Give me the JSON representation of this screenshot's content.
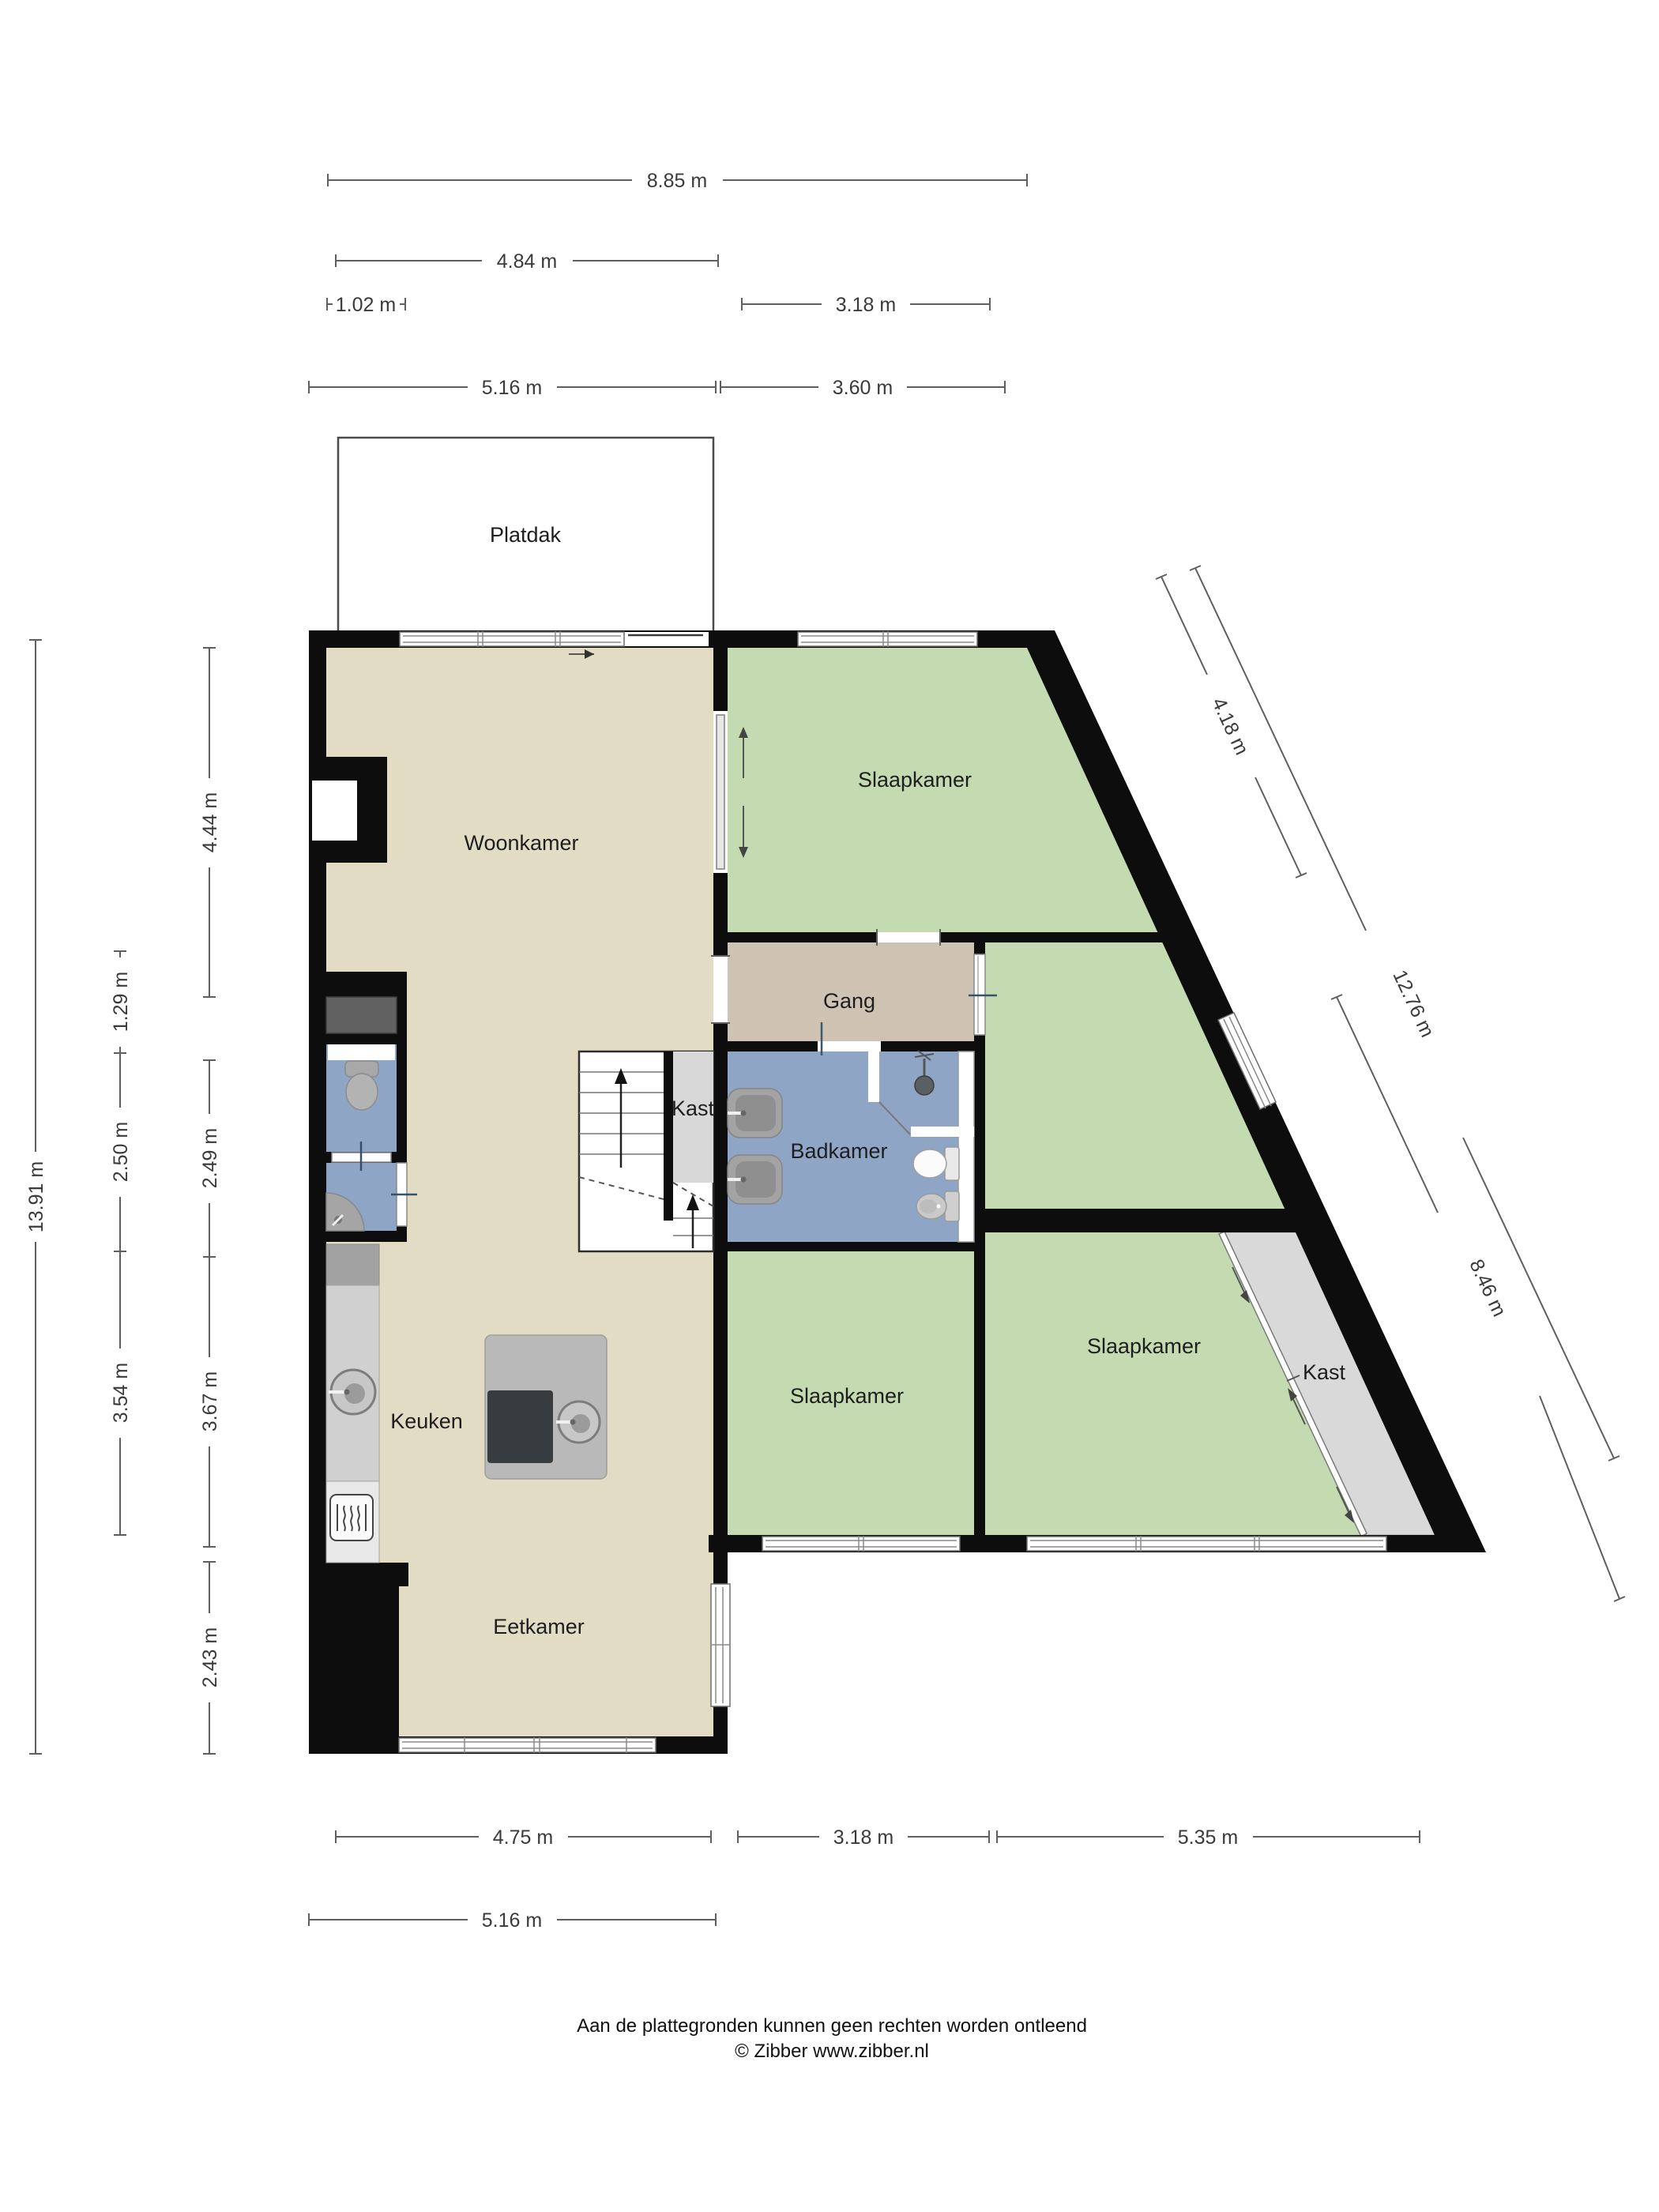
{
  "title": "Plattegrond verdieping",
  "rooms": {
    "platdak": "Platdak",
    "woonkamer": "Woonkamer",
    "slaapkamer_top": "Slaapkamer",
    "gang": "Gang",
    "kast_trap": "Kast",
    "badkamer": "Badkamer",
    "slaapkamer_mid": "Slaapkamer",
    "slaapkamer_rechts": "Slaapkamer",
    "kast_rechts": "Kast",
    "keuken": "Keuken",
    "eetkamer": "Eetkamer"
  },
  "dimensions": {
    "top_total": "8.85 m",
    "top_platdak": "4.84 m",
    "top_klein": "1.02 m",
    "top_rechts": "3.18 m",
    "rij2_links": "5.16 m",
    "rij2_rechts": "3.60 m",
    "links_totaal": "13.91 m",
    "links_129": "1.29 m",
    "links_250": "2.50 m",
    "links_354": "3.54 m",
    "links_444": "4.44 m",
    "links_249": "2.49 m",
    "links_367": "3.67 m",
    "links_243": "2.43 m",
    "diag_418": "4.18 m",
    "diag_1276": "12.76 m",
    "diag_846": "8.46 m",
    "onder_475": "4.75 m",
    "onder_318": "3.18 m",
    "onder_535": "5.35 m",
    "onder_516": "5.16 m"
  },
  "footer": {
    "disclaimer": "Aan de plattegronden kunnen geen rechten worden ontleend",
    "copyright": "© Zibber www.zibber.nl"
  },
  "colors": {
    "floor_beige": "#e3dcc5",
    "room_green": "#c4dbb2",
    "hall_tan": "#cec3b2",
    "bath_blue": "#8fa5c5",
    "closet_gray": "#d9d9d9",
    "counter_gray": "#d0d0d0",
    "island_gray": "#b9b9b9",
    "cooktop_dark": "#383c3f",
    "shaft_gray": "#616161",
    "wall_black": "#0d0d0d"
  }
}
